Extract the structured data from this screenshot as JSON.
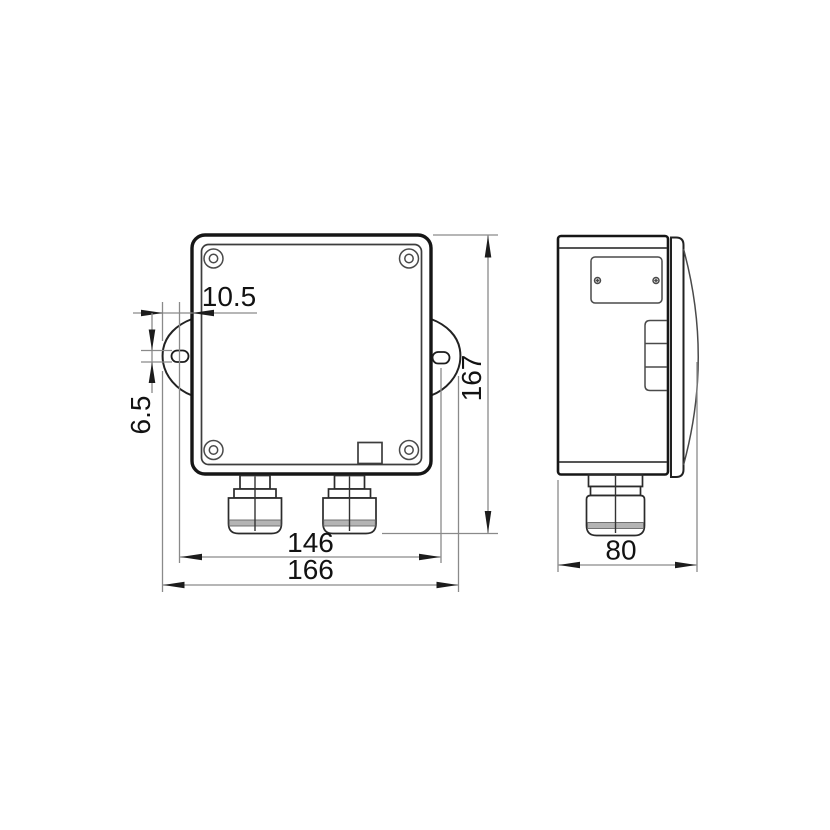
{
  "drawing": {
    "front_view": {
      "dim_tab_offset": "10.5",
      "dim_slot_height": "6.5",
      "dim_overall_height": "167",
      "dim_hole_spacing": "146",
      "dim_overall_width": "166"
    },
    "side_view": {
      "dim_depth": "80"
    },
    "colors": {
      "outline": "#161616",
      "detail": "#3d3d3d",
      "dimension_line": "#8a8a8a",
      "arrow": "#1c1c1c",
      "label_text": "#121212",
      "gland_band": "#b4b4b4",
      "background": "#ffffff"
    }
  }
}
